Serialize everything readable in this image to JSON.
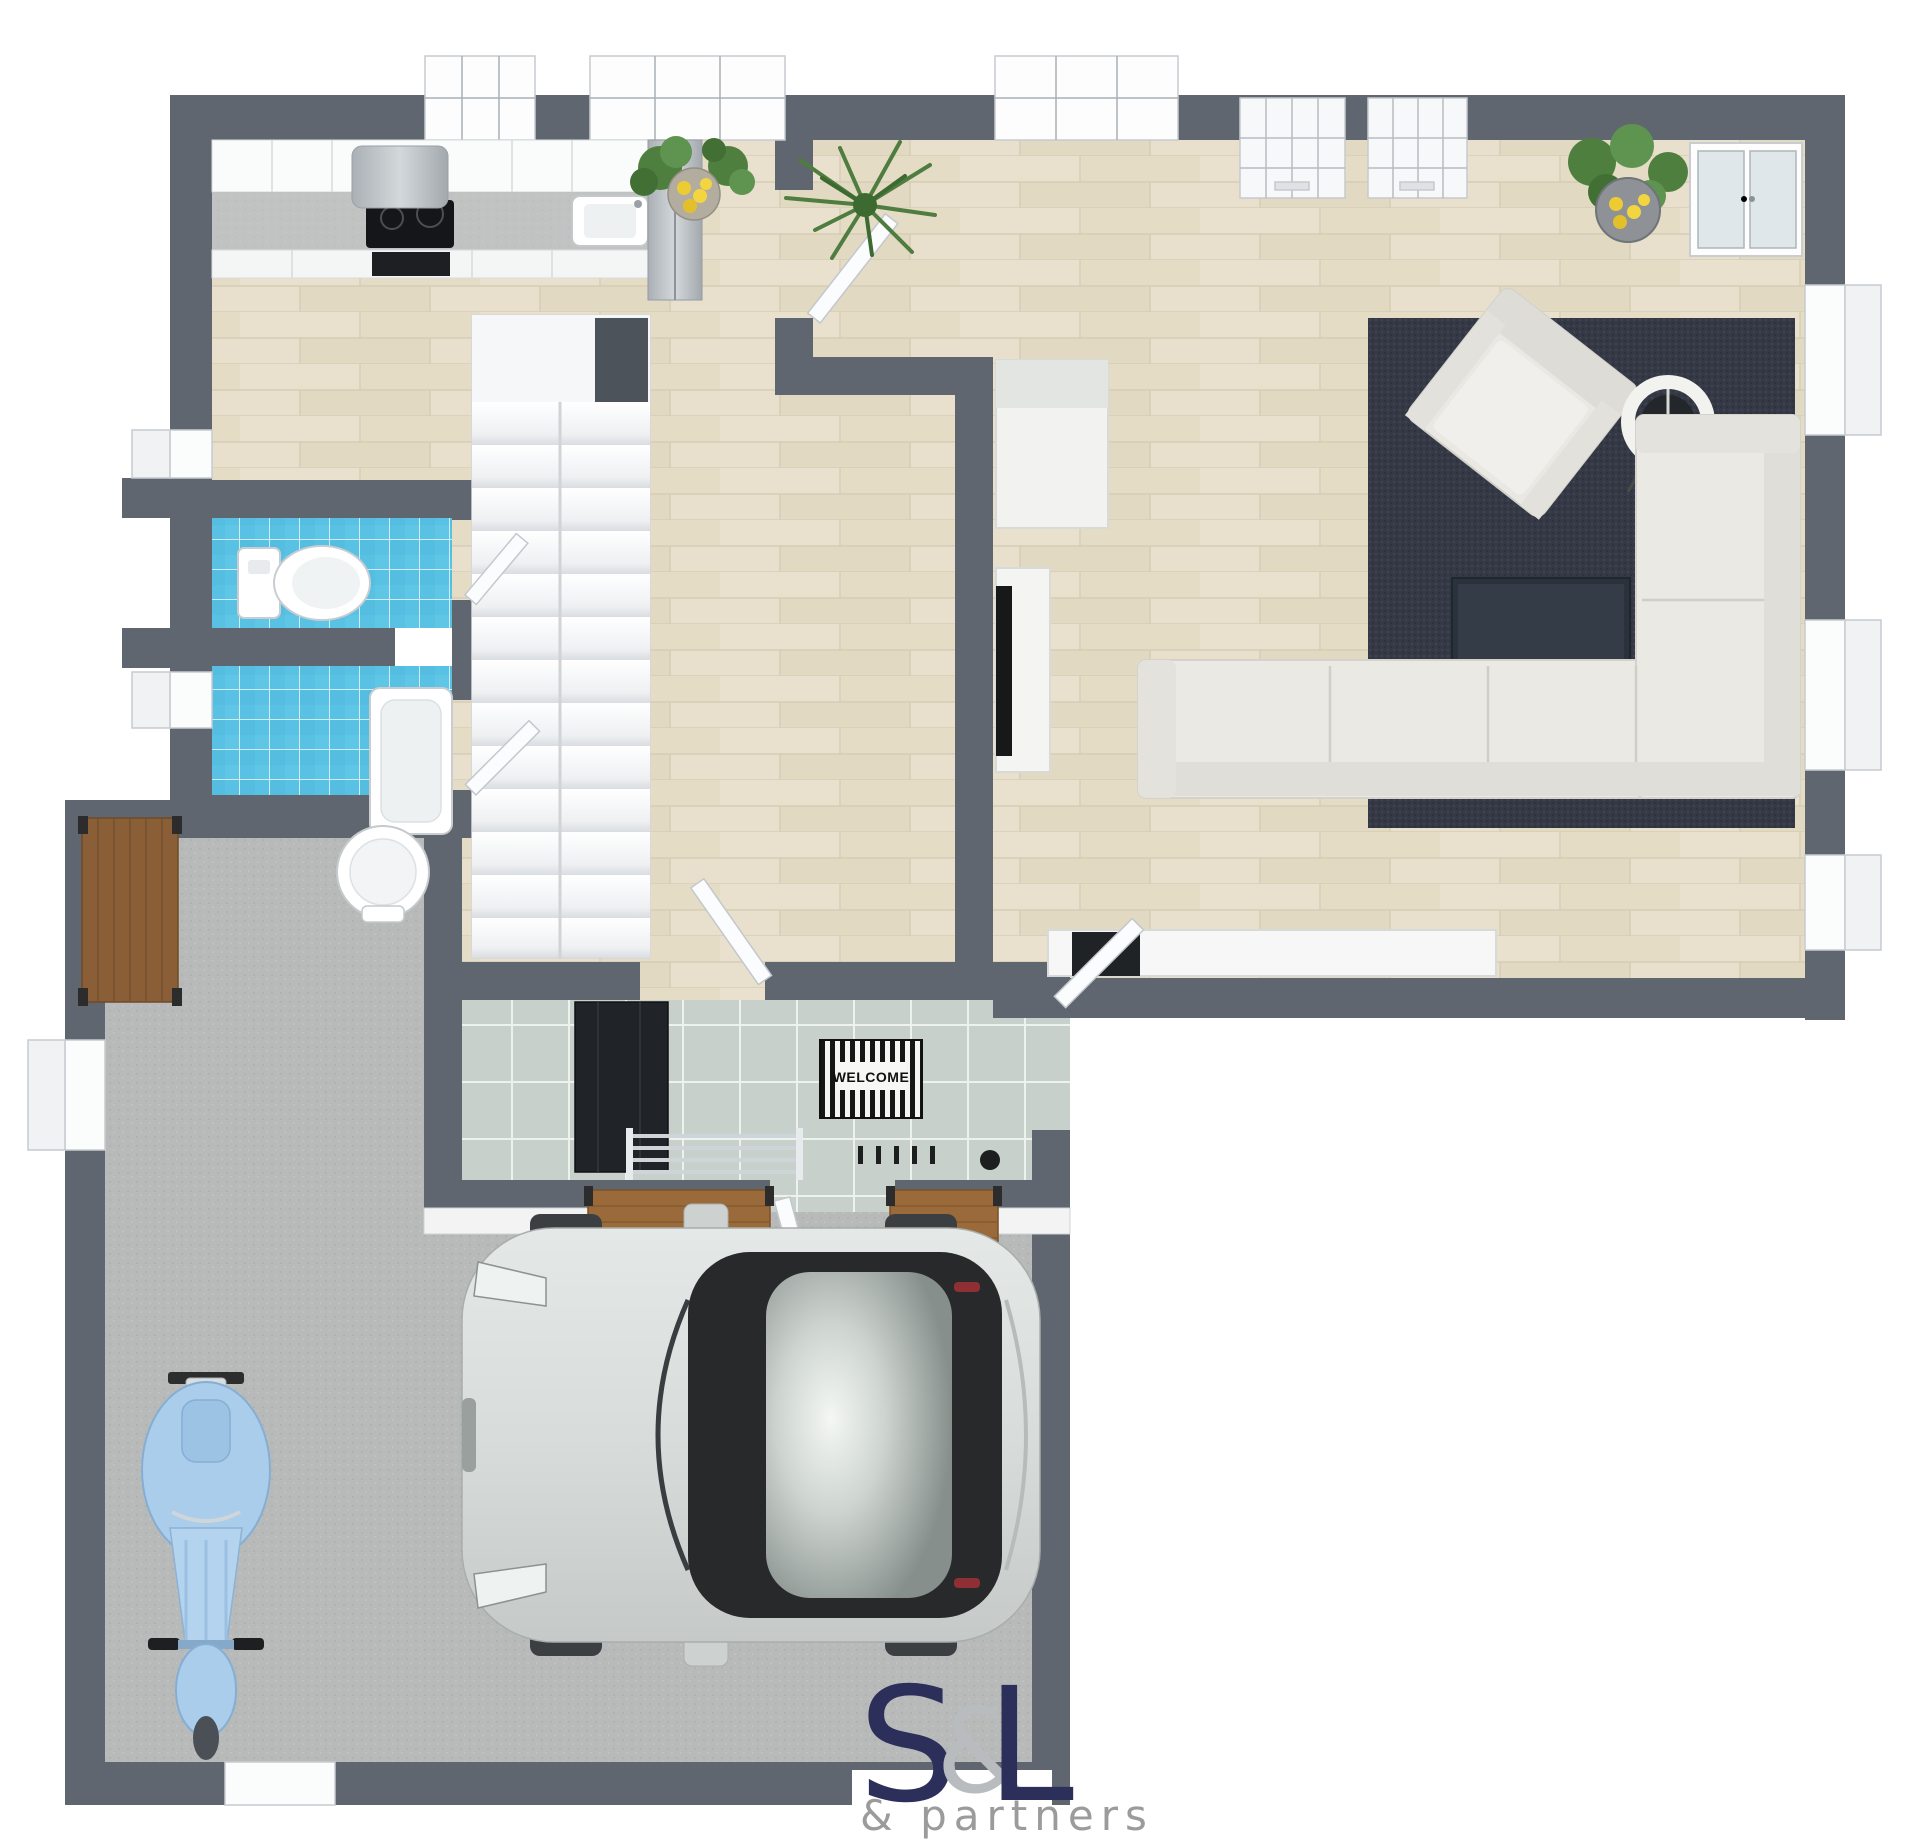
{
  "meta": {
    "kind": "3d-floor-plan-rendering",
    "view": "top-down"
  },
  "entrance": {
    "mat_text": "WELCOME"
  },
  "branding": {
    "mark_s": "S",
    "mark_amp": "&",
    "mark_l": "L",
    "tagline": "& partners",
    "navy": "#2b2f5a",
    "amp_gray": "#b9bcbf",
    "tagline_gray": "#9b9b9b"
  },
  "palette": {
    "wall": "#5f666f",
    "wood_floor": "#e8e0cc",
    "bath_tile": "#59c1e3",
    "entry_tile": "#c7d0ca",
    "garage_concrete": "#b7bab9",
    "rug": "#343945",
    "sofa": "#eae9e4",
    "bench_wood": "#9a6a3a",
    "scooter_blue": "#a9cdeb",
    "car_silver": "#d8dcda"
  }
}
